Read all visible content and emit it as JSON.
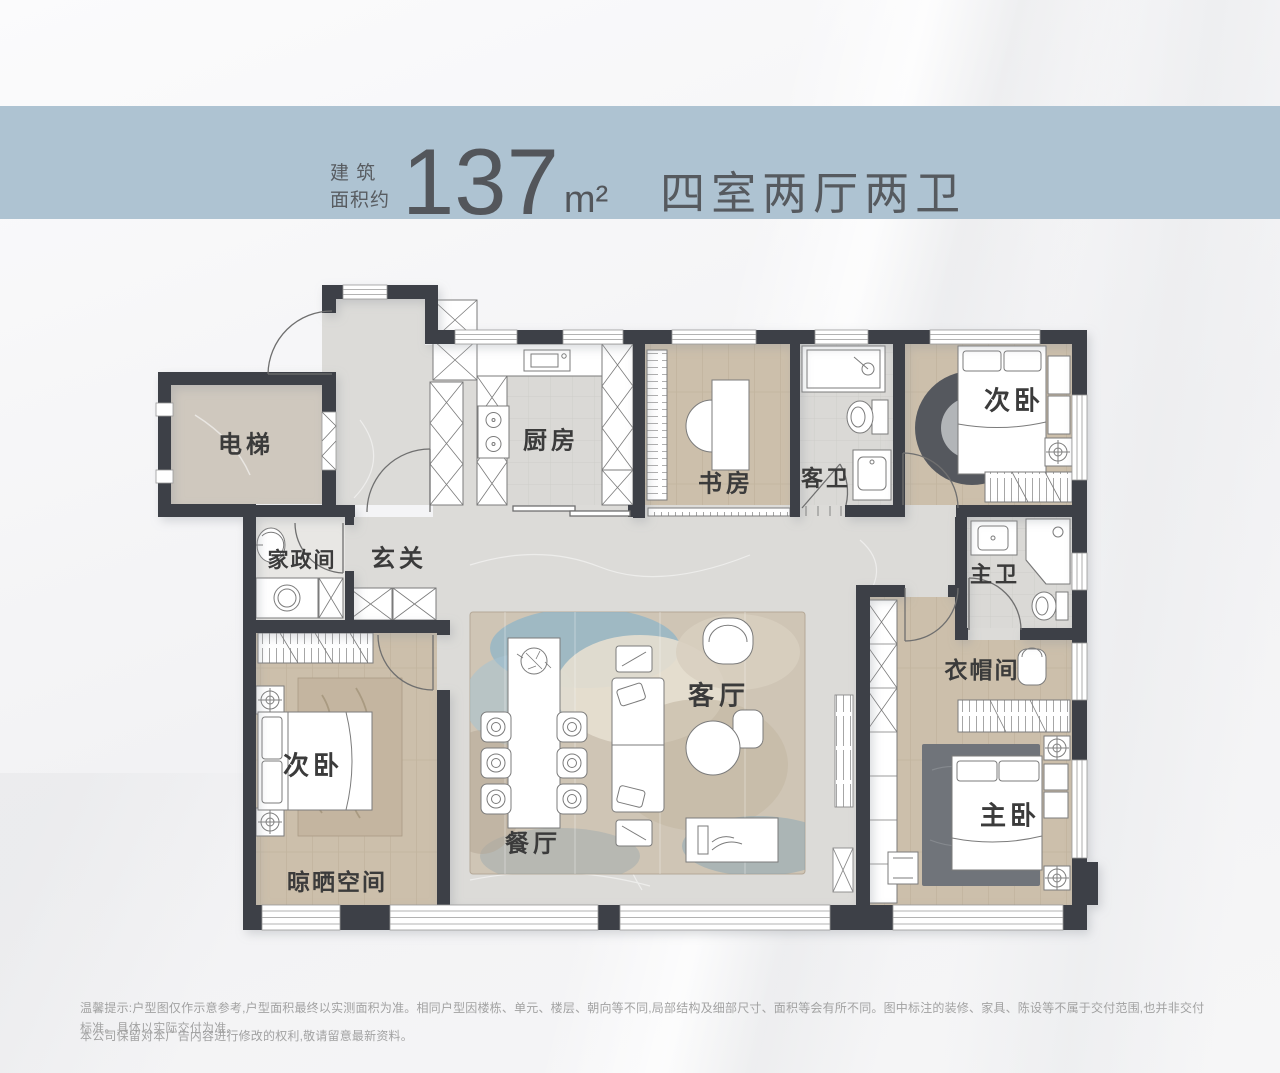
{
  "header": {
    "label_line1": "建 筑",
    "label_line2": "面积约",
    "area": "137",
    "unit": "m²",
    "title": "四室两厅两卫"
  },
  "floorplan": {
    "rooms": [
      {
        "id": "elevator",
        "label": "电梯"
      },
      {
        "id": "housekeeping",
        "label": "家政间"
      },
      {
        "id": "foyer",
        "label": "玄关"
      },
      {
        "id": "kitchen",
        "label": "厨房"
      },
      {
        "id": "study",
        "label": "书房"
      },
      {
        "id": "guest-bath",
        "label": "客卫"
      },
      {
        "id": "bedroom-north",
        "label": "次卧"
      },
      {
        "id": "master-bath",
        "label": "主卫"
      },
      {
        "id": "cloakroom",
        "label": "衣帽间"
      },
      {
        "id": "living-room",
        "label": "客厅"
      },
      {
        "id": "dining-room",
        "label": "餐厅"
      },
      {
        "id": "bedroom-west",
        "label": "次卧"
      },
      {
        "id": "drying-space",
        "label": "晾晒空间"
      },
      {
        "id": "master-bedroom",
        "label": "主卧"
      }
    ],
    "colors": {
      "band": "#aec3d2",
      "wall": "#3e4147",
      "marble_floor": "#dcdbd8",
      "wood_floor": "#ccbfab",
      "tile_floor": "#dad9d6",
      "elevator_floor": "#cfc8be",
      "rug_blue": "#8fb4c8",
      "label_text": "#3b3b3b"
    }
  },
  "footer": {
    "line1": "温馨提示:户型图仅作示意参考,户型面积最终以实测面积为准。相同户型因楼栋、单元、楼层、朝向等不同,局部结构及细部尺寸、面积等会有所不同。图中标注的装修、家具、陈设等不属于交付范围,也并非交付标准。具体以实际交付为准。",
    "line2": "本公司保留对本广告内容进行修改的权利,敬请留意最新资料。"
  }
}
